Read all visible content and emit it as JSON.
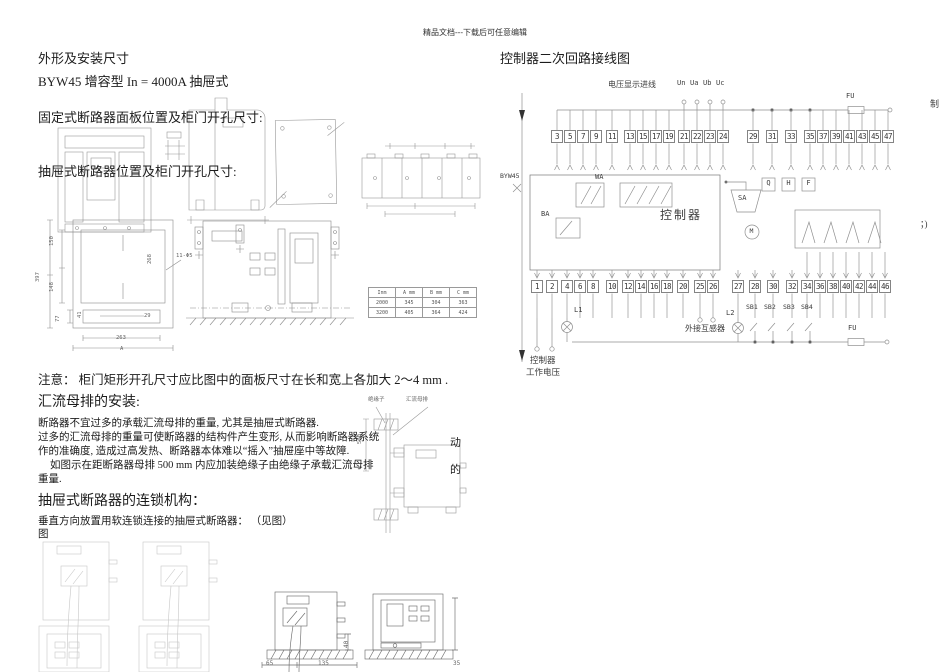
{
  "header": {
    "watermark": "精品文档---下载后可任意编辑"
  },
  "left": {
    "title": "外形及安装尺寸",
    "model_line": "BYW45 增容型 In = 4000A 抽屉式",
    "fixed_caption": "固定式断路器面板位置及柜门开孔尺寸:",
    "drawer_caption": "抽屉式断路器位置及柜门开孔尺寸:",
    "dim_table": {
      "headers": [
        "Inm",
        "A mm",
        "B mm",
        "C mm"
      ],
      "rows": [
        [
          "2000",
          "345",
          "304",
          "363"
        ],
        [
          "3200",
          "405",
          "364",
          "424"
        ]
      ]
    },
    "note": "注意： 柜门矩形开孔尺寸应比图中的面板尺寸在长和宽上各加大 2～4 mm .",
    "busbar_heading": "汇流母排的安装:",
    "busbar_para": [
      "断路器不宜过多的承载汇流母排的重量, 尤其是抽屉式断路器.",
      "过多的汇流母排的重量可使断路器的结构件产生变形, 从而影响断路器系统",
      "作的准确度, 造成过高发热、断路器本体难以“摇入”抽屉座中等故障.",
      "如图示在距断路器母排 500 mm 内应加装绝缘子由绝缘子承载汇流母排",
      "重量."
    ],
    "wrap_char_1": "动",
    "wrap_char_2": "的",
    "interlock_heading": "抽屉式断路器的连锁机构：",
    "interlock_line": "垂直方向放置用软连锁连接的抽屉式断路器： （见图）",
    "interlock_fig": "图",
    "inset": {
      "insulator": "绝缘子",
      "busbar": "汇流母排",
      "dim500": "500"
    },
    "drawing_dims": {
      "d150": "150",
      "d148": "148",
      "d397": "397",
      "d41": "41",
      "d77": "77",
      "d263": "263",
      "d268": "268",
      "dA": "A",
      "dphi": "11-Φ5",
      "d29": "29"
    },
    "bottom_dims": {
      "d65": "65",
      "d135": "135",
      "d40": "40",
      "d35": "35"
    }
  },
  "diagram": {
    "title": "控制器二次回路接线图",
    "voltage_label": "电压显示进线",
    "voltage_terminals": [
      "Un",
      "Ua",
      "Ub",
      "Uc"
    ],
    "breaker_label": "BYW45",
    "fuse_top": "FU",
    "fuse_bottom": "FU",
    "edge_char_top": "制",
    "edge_char_right": "；)",
    "top_terminal_groups": [
      [
        "3",
        "5",
        "7",
        "9"
      ],
      [
        "11"
      ],
      [
        "13",
        "15",
        "17",
        "19"
      ],
      [
        "21",
        "22",
        "23",
        "24"
      ],
      [
        "29"
      ],
      [
        "31"
      ],
      [
        "33"
      ],
      [
        "35",
        "37",
        "39",
        "41",
        "43",
        "45",
        "47"
      ]
    ],
    "bottom_terminal_groups": [
      [
        "1"
      ],
      [
        "2"
      ],
      [
        "4",
        "6",
        "8"
      ],
      [
        "10"
      ],
      [
        "12",
        "14",
        "16",
        "18"
      ],
      [
        "20"
      ],
      [
        "25",
        "26"
      ],
      [
        "27"
      ],
      [
        "28"
      ],
      [
        "30"
      ],
      [
        "32"
      ],
      [
        "34",
        "36",
        "38",
        "40",
        "42",
        "44",
        "46"
      ]
    ],
    "controller_label": "控制器",
    "wa": "WA",
    "ba": "BA",
    "sa": "SA",
    "m": "M",
    "aux": [
      "Q",
      "H",
      "F"
    ],
    "lamp1": "L1",
    "lamp2": "L2",
    "ct_label": "外接互感器",
    "buttons": [
      "SB1",
      "SB2",
      "SB3",
      "SB4"
    ],
    "supply_line1": "控制器",
    "supply_line2": "工作电压"
  }
}
